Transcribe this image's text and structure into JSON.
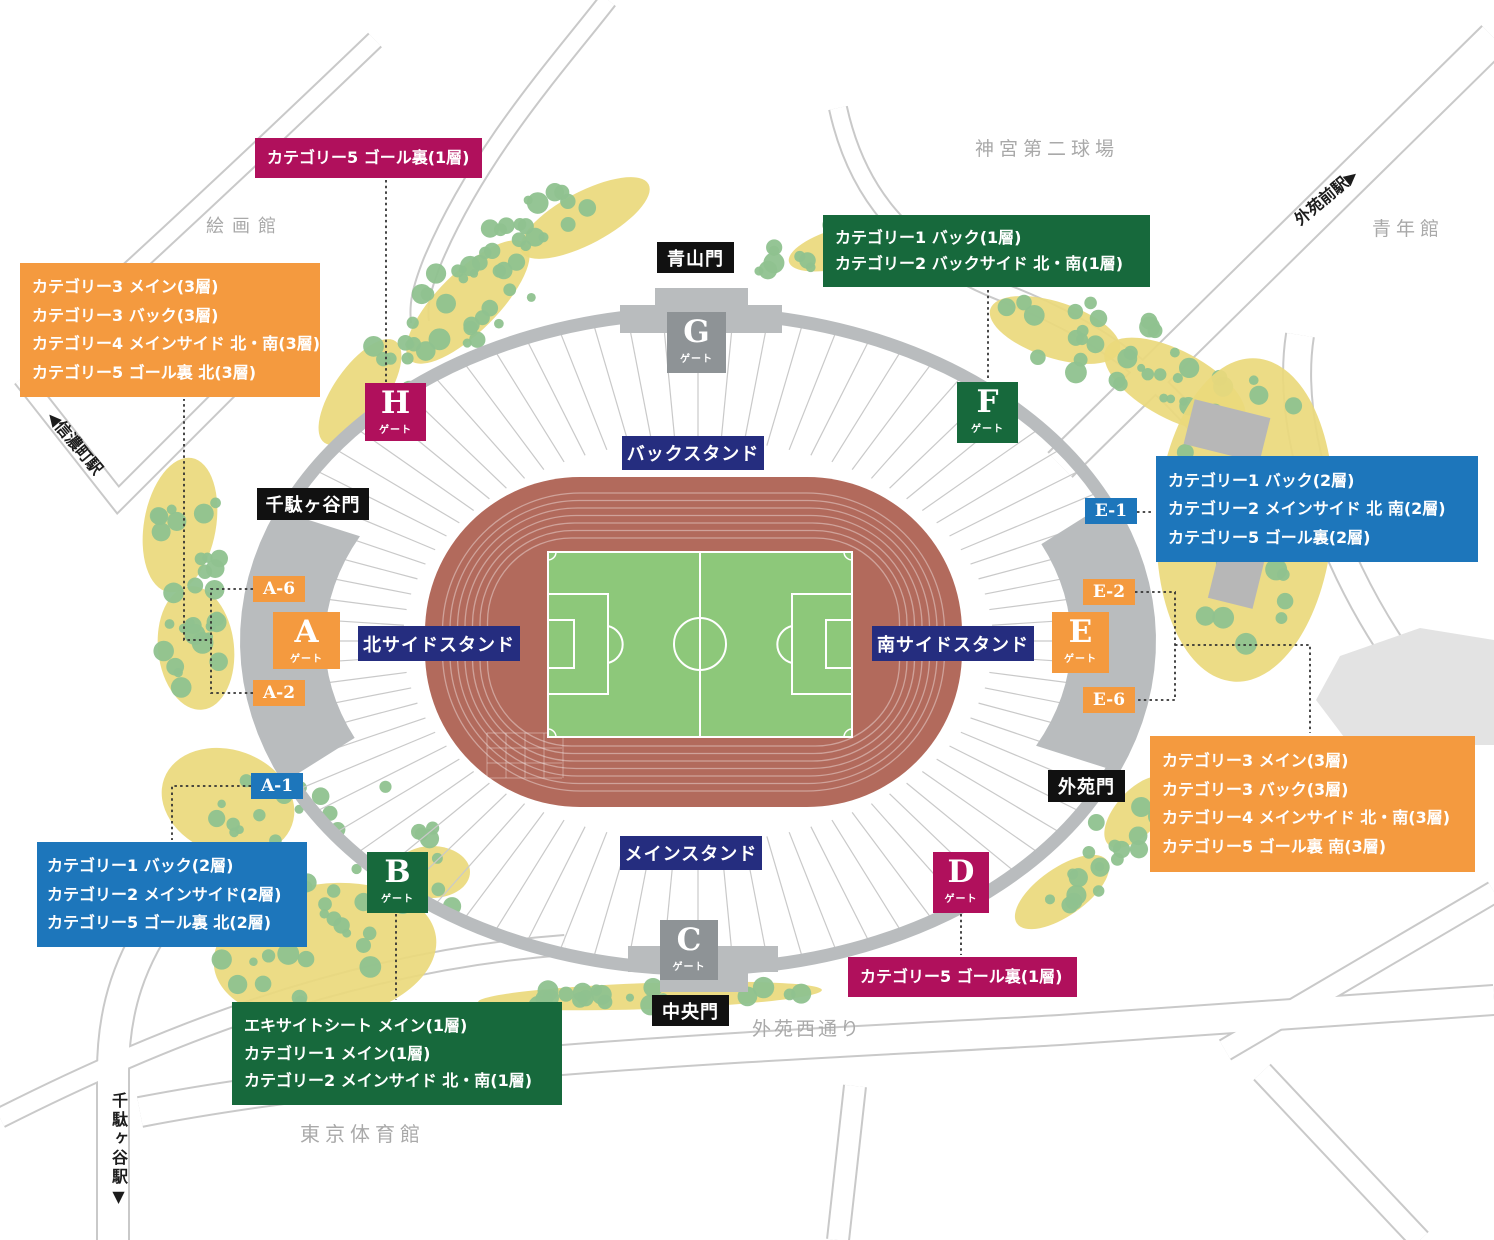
{
  "colors": {
    "orange": "#f49a3f",
    "magenta": "#b0105c",
    "green": "#17693c",
    "blue": "#1d76bb",
    "navy": "#252d7f",
    "gate_gray": "#8e9396",
    "structure_gray": "#b9bcbe",
    "track": "#b26a5c",
    "pitch": "#8dc87a",
    "tree": "#8fc28f",
    "grove": "#ead97c",
    "road_line": "#c9c9c9",
    "muted_text": "#a9a9a9"
  },
  "legend_boxes": [
    {
      "id": "goal-behind-north-1f",
      "color_key": "magenta",
      "lines": [
        "カテゴリー5 ゴール裏(1層)"
      ]
    },
    {
      "id": "west-3f",
      "color_key": "orange",
      "lines": [
        "カテゴリー3 メイン(3層)",
        "カテゴリー3 バック(3層)",
        "カテゴリー4 メインサイド 北・南(3層)",
        "カテゴリー5 ゴール裏 北(3層)"
      ]
    },
    {
      "id": "back-north-1f",
      "color_key": "green",
      "lines": [
        "カテゴリー1 バック(1層)",
        "カテゴリー2 バックサイド 北・南(1層)"
      ]
    },
    {
      "id": "east-2f",
      "color_key": "blue",
      "lines": [
        "カテゴリー1 バック(2層)",
        "カテゴリー2 メインサイド 北 南(2層)",
        "カテゴリー5 ゴール裏(2層)"
      ]
    },
    {
      "id": "east-3f",
      "color_key": "orange",
      "lines": [
        "カテゴリー3 メイン(3層)",
        "カテゴリー3 バック(3層)",
        "カテゴリー4 メインサイド 北・南(3層)",
        "カテゴリー5 ゴール裏 南(3層)"
      ]
    },
    {
      "id": "west-2f",
      "color_key": "blue",
      "lines": [
        "カテゴリー1 バック(2層)",
        "カテゴリー2 メインサイド(2層)",
        "カテゴリー5 ゴール裏 北(2層)"
      ]
    },
    {
      "id": "goal-behind-south-1f",
      "color_key": "magenta",
      "lines": [
        "カテゴリー5 ゴール裏(1層)"
      ]
    },
    {
      "id": "main-1f",
      "color_key": "green",
      "lines": [
        "エキサイトシート メイン(1層)",
        "カテゴリー1 メイン(1層)",
        "カテゴリー2 メインサイド 北・南(1層)"
      ]
    }
  ],
  "gates": [
    {
      "letter": "A",
      "sub": "ゲート"
    },
    {
      "letter": "B",
      "sub": "ゲート"
    },
    {
      "letter": "C",
      "sub": "ゲート"
    },
    {
      "letter": "D",
      "sub": "ゲート"
    },
    {
      "letter": "E",
      "sub": "ゲート"
    },
    {
      "letter": "F",
      "sub": "ゲート"
    },
    {
      "letter": "G",
      "sub": "ゲート"
    },
    {
      "letter": "H",
      "sub": "ゲート"
    }
  ],
  "section_tags": [
    {
      "label": "A-6"
    },
    {
      "label": "A-2"
    },
    {
      "label": "A-1"
    },
    {
      "label": "E-1"
    },
    {
      "label": "E-2"
    },
    {
      "label": "E-6"
    }
  ],
  "entrances": [
    {
      "label": "青山門"
    },
    {
      "label": "千駄ヶ谷門"
    },
    {
      "label": "外苑門"
    },
    {
      "label": "中央門"
    }
  ],
  "stands": [
    {
      "label": "バックスタンド"
    },
    {
      "label": "メインスタンド"
    },
    {
      "label": "北サイドスタンド"
    },
    {
      "label": "南サイドスタンド"
    }
  ],
  "places": [
    {
      "label": "絵画館"
    },
    {
      "label": "神宮第二球場"
    },
    {
      "label": "青年館"
    },
    {
      "label": "東京体育館"
    },
    {
      "label": "外苑西通り"
    }
  ],
  "stations": [
    {
      "name": "外苑前駅",
      "arrow": "▶"
    },
    {
      "name": "信濃町駅",
      "arrow": "◀"
    },
    {
      "name": "千駄ヶ谷駅",
      "arrow": "▼"
    }
  ]
}
